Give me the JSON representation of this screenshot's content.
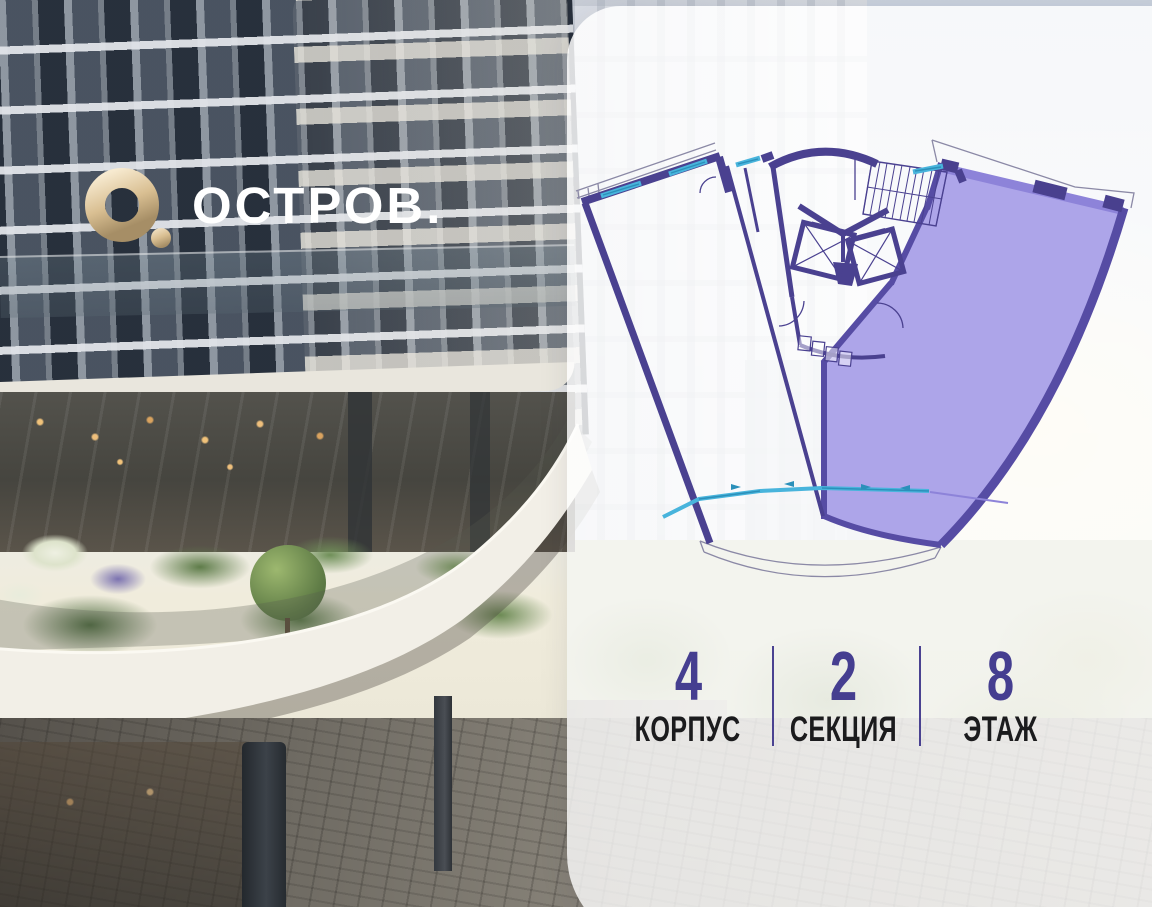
{
  "brand": {
    "name": "ОСТРОВ."
  },
  "unit_info": {
    "items": [
      {
        "value": "4",
        "label": "КОРПУС"
      },
      {
        "value": "2",
        "label": "СЕКЦИЯ"
      },
      {
        "value": "8",
        "label": "ЭТАЖ"
      }
    ]
  },
  "floor_plan": {
    "highlighted_unit": "right-wing-apartment",
    "colors": {
      "wall": "#4a4190",
      "highlight_fill": "#a9a0e8",
      "highlight_wall": "#564ca4",
      "highlight_band": "#8d83d9",
      "window": "#48b4dc",
      "outline": "#8b89a6"
    }
  },
  "logo": {
    "gold": "#d9bf92",
    "text_color": "#ffffff"
  },
  "info_accent": "#453e90"
}
